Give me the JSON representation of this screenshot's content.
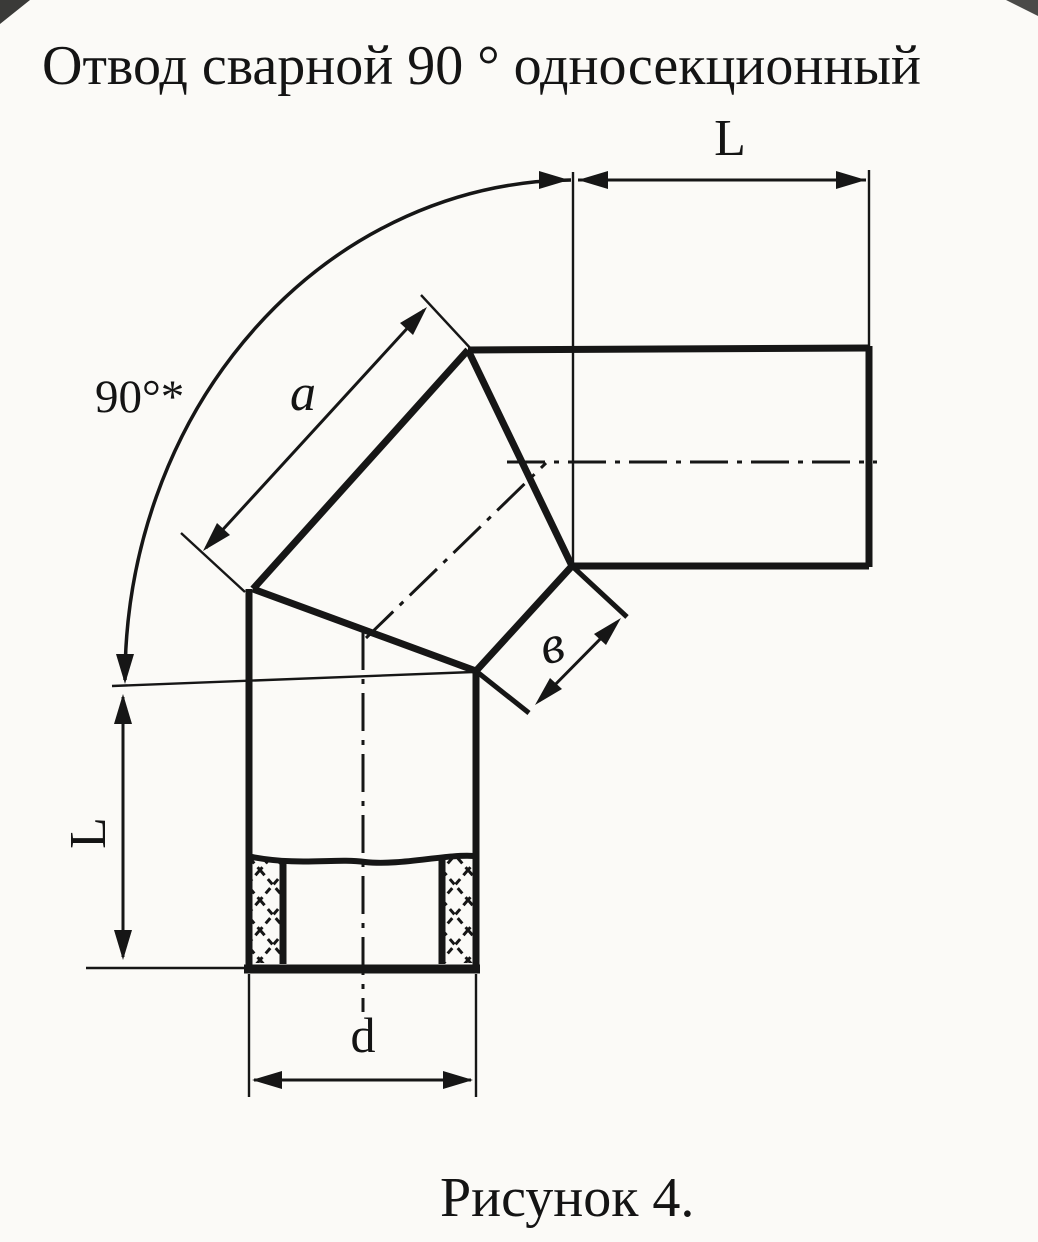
{
  "title": "Отвод сварной 90 ° односекционный",
  "caption": "Рисунок 4.",
  "diagram": {
    "type": "technical-drawing",
    "subject": "welded 90-degree single-section pipe elbow",
    "labels": {
      "angle": "90°*",
      "length_top": "L",
      "length_left": "L",
      "segment_a": "a",
      "segment_b": "в",
      "diameter": "d"
    },
    "ink_color": "#161616",
    "paper_color": "#fbfaf7"
  }
}
